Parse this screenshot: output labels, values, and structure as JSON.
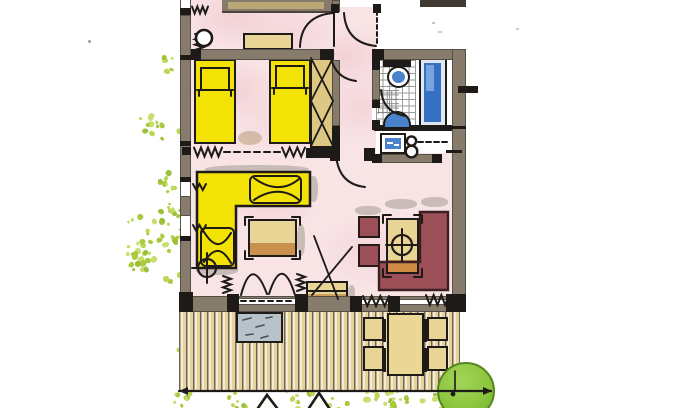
{
  "document": {
    "kind": "scanned hand-coloured architectural floor plan of an apartment with terrace",
    "visible_text": "none"
  },
  "palette": {
    "paper": "#ffffff",
    "pink": "#f8e3e5",
    "wall": "#877b6c",
    "wallD": "#564f45",
    "ink": "#1d1a17",
    "yellow": "#f2e205",
    "tan": "#e8d494",
    "brown": "#c9914d",
    "wtan": "#dcc883",
    "maroon": "#9c4f56",
    "maroonD": "#5e2e33",
    "blue": "#3570c2",
    "blueFix": "#4a82cc",
    "mat": "#b7c2cb",
    "deckBg": "#f4ecd4",
    "plankA": "#f4ecd4",
    "plankB": "#e7d399",
    "plankLine": "#6f6353",
    "tree": "#8cc63f",
    "treeD": "#55871f",
    "shadow": "#9a948c",
    "tile": "#9a9a9a"
  },
  "veg_colors": [
    "#bcd754",
    "#a9ca3f",
    "#c8de6e",
    "#9cc038"
  ],
  "plan": {
    "rooms": [
      {
        "name": "top-room",
        "floor": "pink wash",
        "furniture": [
          "sideboard (cut by image edge)",
          "round stool",
          "tan bench"
        ],
        "symbols": [
          "radiator zigzag",
          "door swing arc"
        ]
      },
      {
        "name": "hallway",
        "floor": "pink wash",
        "symbols": [
          "entry door arc",
          "dashed opening",
          "door arcs to rooms"
        ]
      },
      {
        "name": "bedroom",
        "floor": "pink wash",
        "furniture": [
          "single bed",
          "single bed",
          "wardrobe with X-brace"
        ],
        "symbols": [
          "radiator zigzags with dashed window line"
        ]
      },
      {
        "name": "bathroom",
        "floor": "white tiles",
        "fixtures": [
          "toilet",
          "bathtub",
          "washbasin half-circle"
        ],
        "symbols": [
          "door swing arc"
        ]
      },
      {
        "name": "kitchenette-niche",
        "fixtures": [
          "sink unit",
          "two-burner hob"
        ],
        "symbols": [
          "dashed counter line"
        ]
      },
      {
        "name": "living-room",
        "floor": "pink wash",
        "furniture": [
          "yellow corner sofa with cushions",
          "coffee table",
          "chest with TV antenna lines",
          "maroon corner bench",
          "dining table",
          "2 maroon chairs",
          "floor lamp symbol",
          "ceiling lamp symbol"
        ],
        "symbols": [
          "french double door arcs",
          "radiator zigzags"
        ]
      },
      {
        "name": "terrace",
        "floor": "wooden deck planks",
        "furniture": [
          "doormat",
          "garden table",
          "4 garden chairs"
        ],
        "symbols": [
          "dimension line with arrowheads",
          "two cut-off arrow tips at lower edge"
        ]
      }
    ],
    "outdoor": {
      "tree_count": 1,
      "vegetation": "scattered yellow-green dots along left edge and bottom strip"
    },
    "counts": {
      "beds": 2,
      "garden_chairs": 4,
      "dining_chairs": 2,
      "door_arcs": 7,
      "radiator_zigzags": 10
    }
  },
  "decorations": {
    "clusters_left": {
      "x": 127,
      "y": 12,
      "w": 56,
      "h": 378,
      "clusters": 14,
      "seed": 42
    },
    "clusters_bottom": {
      "x": 158,
      "y": 388,
      "w": 318,
      "h": 18,
      "clusters": 12,
      "seed": 99
    }
  }
}
